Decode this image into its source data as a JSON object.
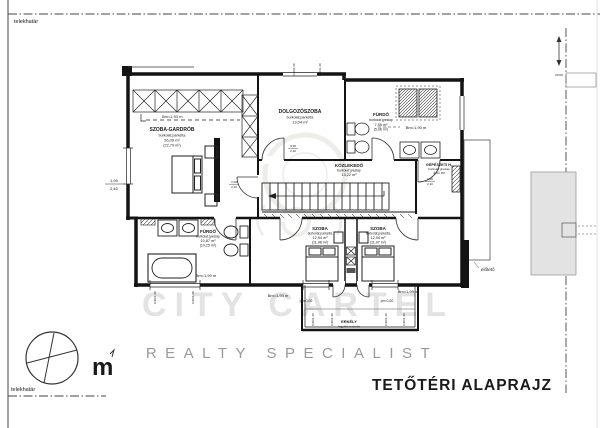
{
  "page": {
    "title": "TETŐTÉRI ALAPRAJZ",
    "boundary_top": "telekhatár",
    "boundary_bottom": "telekhatár",
    "canopy": "előtető",
    "north_symbol": "m"
  },
  "watermark": {
    "big": "CITY CARTEL",
    "tagline": "REALTY SPECIALIST"
  },
  "rooms": {
    "gardrob": {
      "name": "SZOBA-GARDRÓB",
      "finish": "burkolat:parketta",
      "area": "26,09 m²",
      "area_reduced": "(22,79 m²)",
      "height": "Bm=1,93 m"
    },
    "dolgozo": {
      "name": "DOLGOZÓSZOBA",
      "finish": "burkolat:parketta",
      "area": "13,04 m²"
    },
    "furdo_top": {
      "name": "FÜRDŐ",
      "finish": "burkolat:greslap",
      "area": "7,55 m²",
      "area_reduced": "(5,96 m²)",
      "height": "Bm=1,90 m"
    },
    "gepeszeti": {
      "name": "GÉPÉSZETI H.",
      "finish": "burkolat:greslap",
      "area": "4,61 m²"
    },
    "kozlekedo": {
      "name": "KÖZLEKEDŐ",
      "finish": "burkolat:greslap",
      "area": "13,22 m²"
    },
    "furdo_lower": {
      "name": "FÜRDŐ",
      "finish": "burkolat:greslap",
      "area": "10,87 m²",
      "area_reduced": "(10,25 m²)",
      "height": "Bm=1,90 m"
    },
    "szoba_left": {
      "name": "SZOBA",
      "finish": "burkolat:parketta",
      "area": "12,94 m²",
      "area_reduced": "(11,98 m²)"
    },
    "szoba_right": {
      "name": "SZOBA",
      "finish": "burkolat:parketta",
      "area": "12,94 m²",
      "area_reduced": "(11,97 m²)"
    },
    "erkely": {
      "name": "ERKÉLY",
      "finish": "fagyálló burkolat"
    }
  },
  "annotations": {
    "height_left": "Bm=1,93 m",
    "height_right": "Bm=1,99 m",
    "level_left": "pm 0,00",
    "level_right": "pm 0,00",
    "door_w": "1,00",
    "door_h": "2,10",
    "door2_w": "0,90",
    "door2_h": "2,10",
    "window_w": "1,95",
    "window_h": "2,40",
    "win_small": "0,90/1,40"
  },
  "colors": {
    "ink": "#1a1a1a",
    "watermark": "#9a9283",
    "neighbor_fill": "#e3e3e3"
  }
}
